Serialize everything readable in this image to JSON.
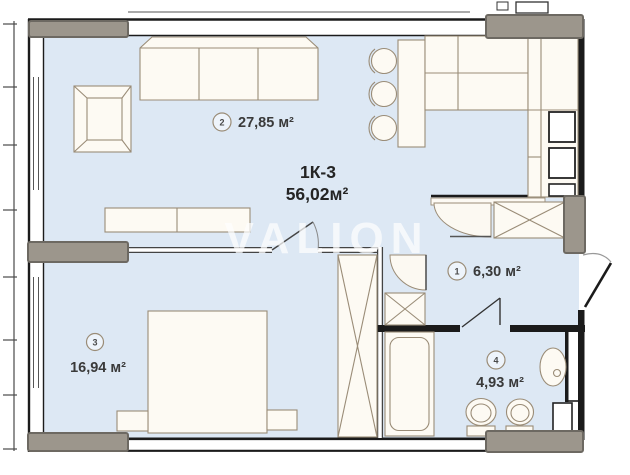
{
  "plan": {
    "watermark": "VALION",
    "title": {
      "line1": "1К-3",
      "line2": "56,02м²"
    },
    "rooms": [
      {
        "number": "1",
        "area": "6,30 м²"
      },
      {
        "number": "2",
        "area": "27,85 м²"
      },
      {
        "number": "3",
        "area": "16,94 м²"
      },
      {
        "number": "4",
        "area": "4,93 м²"
      }
    ],
    "colors": {
      "floor": "#dde8f4",
      "walls": "#1b1b1b",
      "furniture_outline": "#9a8c77",
      "balcony_gray": "#9c968c",
      "label_text": "#3a3a3a",
      "watermark": "#ffffff"
    }
  }
}
